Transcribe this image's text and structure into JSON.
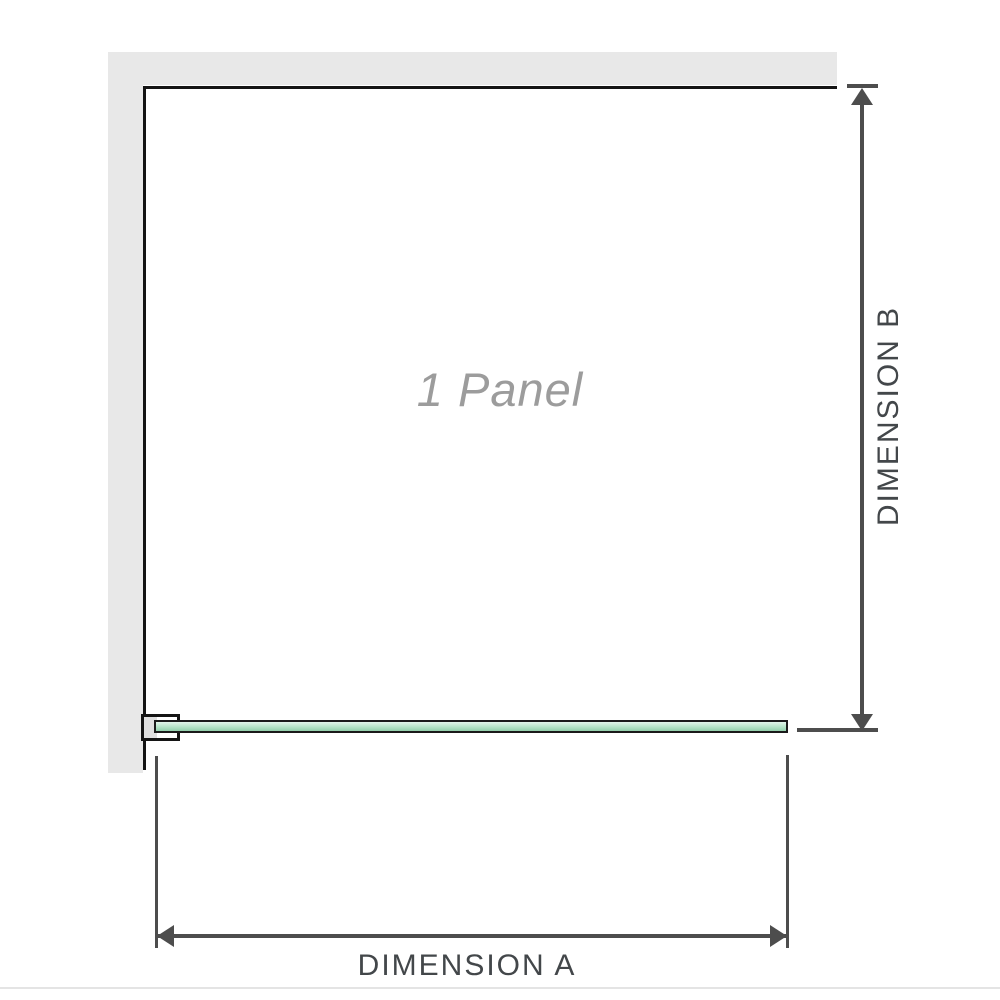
{
  "diagram": {
    "panel_label": "1 Panel",
    "dimension_a": {
      "label": "DIMENSION A"
    },
    "dimension_b": {
      "label": "DIMENSION B"
    },
    "colors": {
      "wall_fill": "#e8e8e8",
      "panel_outline": "#141414",
      "glass_border": "#1a1a1a",
      "glass_top": "#e2f4ea",
      "glass_mid": "#b4e3c7",
      "glass_bottom": "#92cfaa",
      "bracket_fill": "#ffffff",
      "bracket_inner": "#dfdfdf",
      "dimension_line": "#4d4d4d",
      "dimension_text": "#43474a",
      "panel_text": "#9c9c9c",
      "footer_rule": "#e4e4e4"
    }
  }
}
